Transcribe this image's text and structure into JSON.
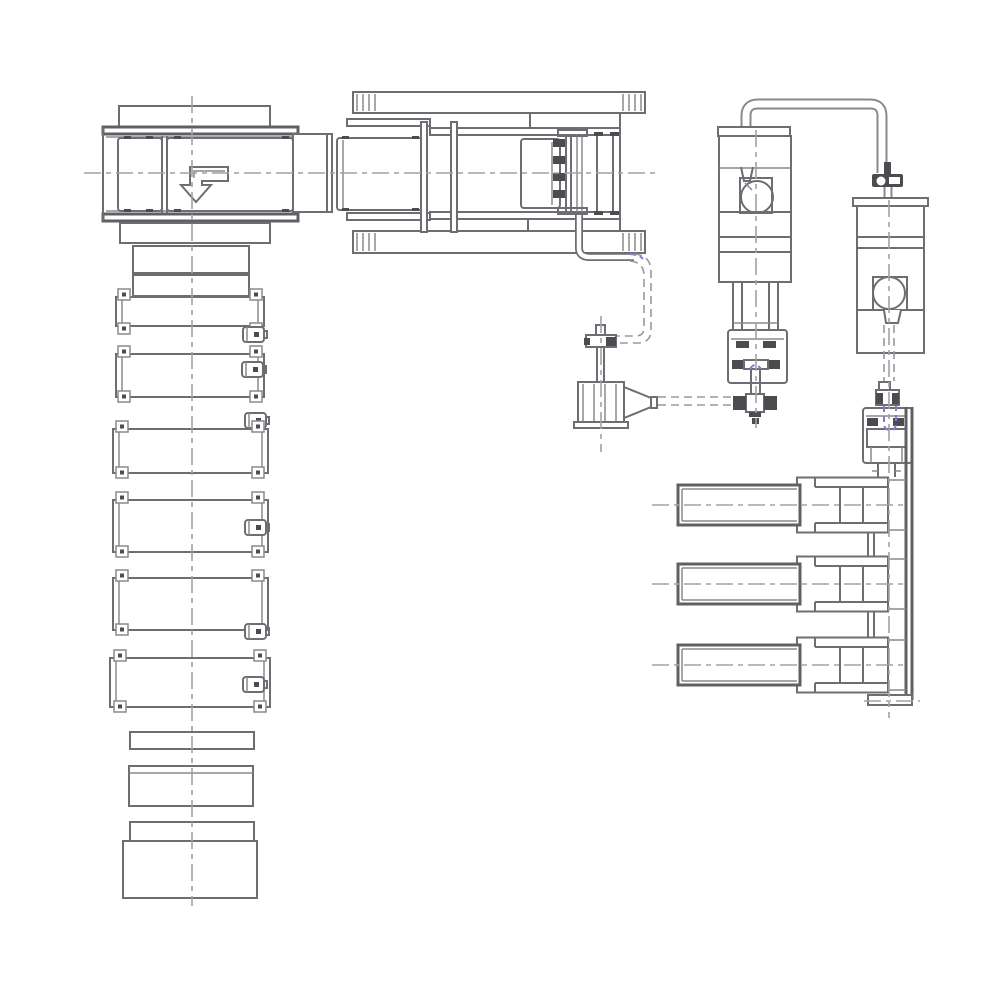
{
  "meta": {
    "description": "Monochrome CAD plan-view line drawing of an industrial machinery line: an infeed machine with a bent down-arrow, a horizontal press line, a long column of stacked clamp sections, two vertical pump units joined by an overhead pipe, a nozzle feeder unit, and a three-arm outfeed station.",
    "background": "#ffffff"
  },
  "palette": {
    "background": "#ffffff",
    "line_main": "#6e6e72",
    "line_heavy": "#606064",
    "line_light": "#8a8a8e",
    "centerline": "#a2a2a6",
    "hidden": "#9898a0",
    "accent": "#8080c8",
    "fill_dark": "#4c4c50"
  },
  "components": {
    "infeed": {
      "label": "Infeed machine with direction arrow"
    },
    "arrow": {
      "label": "Bent down arrow symbol"
    },
    "press": {
      "label": "Horizontal press line with ribbed side bars"
    },
    "stack": {
      "label": "Column of stacked clamp bar sections"
    },
    "pump1": {
      "label": "Vertical pump unit A with volute"
    },
    "pump2": {
      "label": "Vertical pump unit B with volute"
    },
    "pipe": {
      "label": "Overhead transfer pipe with inline valve"
    },
    "nozzle": {
      "label": "Nozzle feeder unit"
    },
    "valve1": {
      "label": "Cross valve fitting under pump A"
    },
    "outfeed": {
      "label": "Three-arm outfeed station on rail"
    },
    "centerlines": {
      "label": "Center lines and hidden dashed lines"
    }
  }
}
